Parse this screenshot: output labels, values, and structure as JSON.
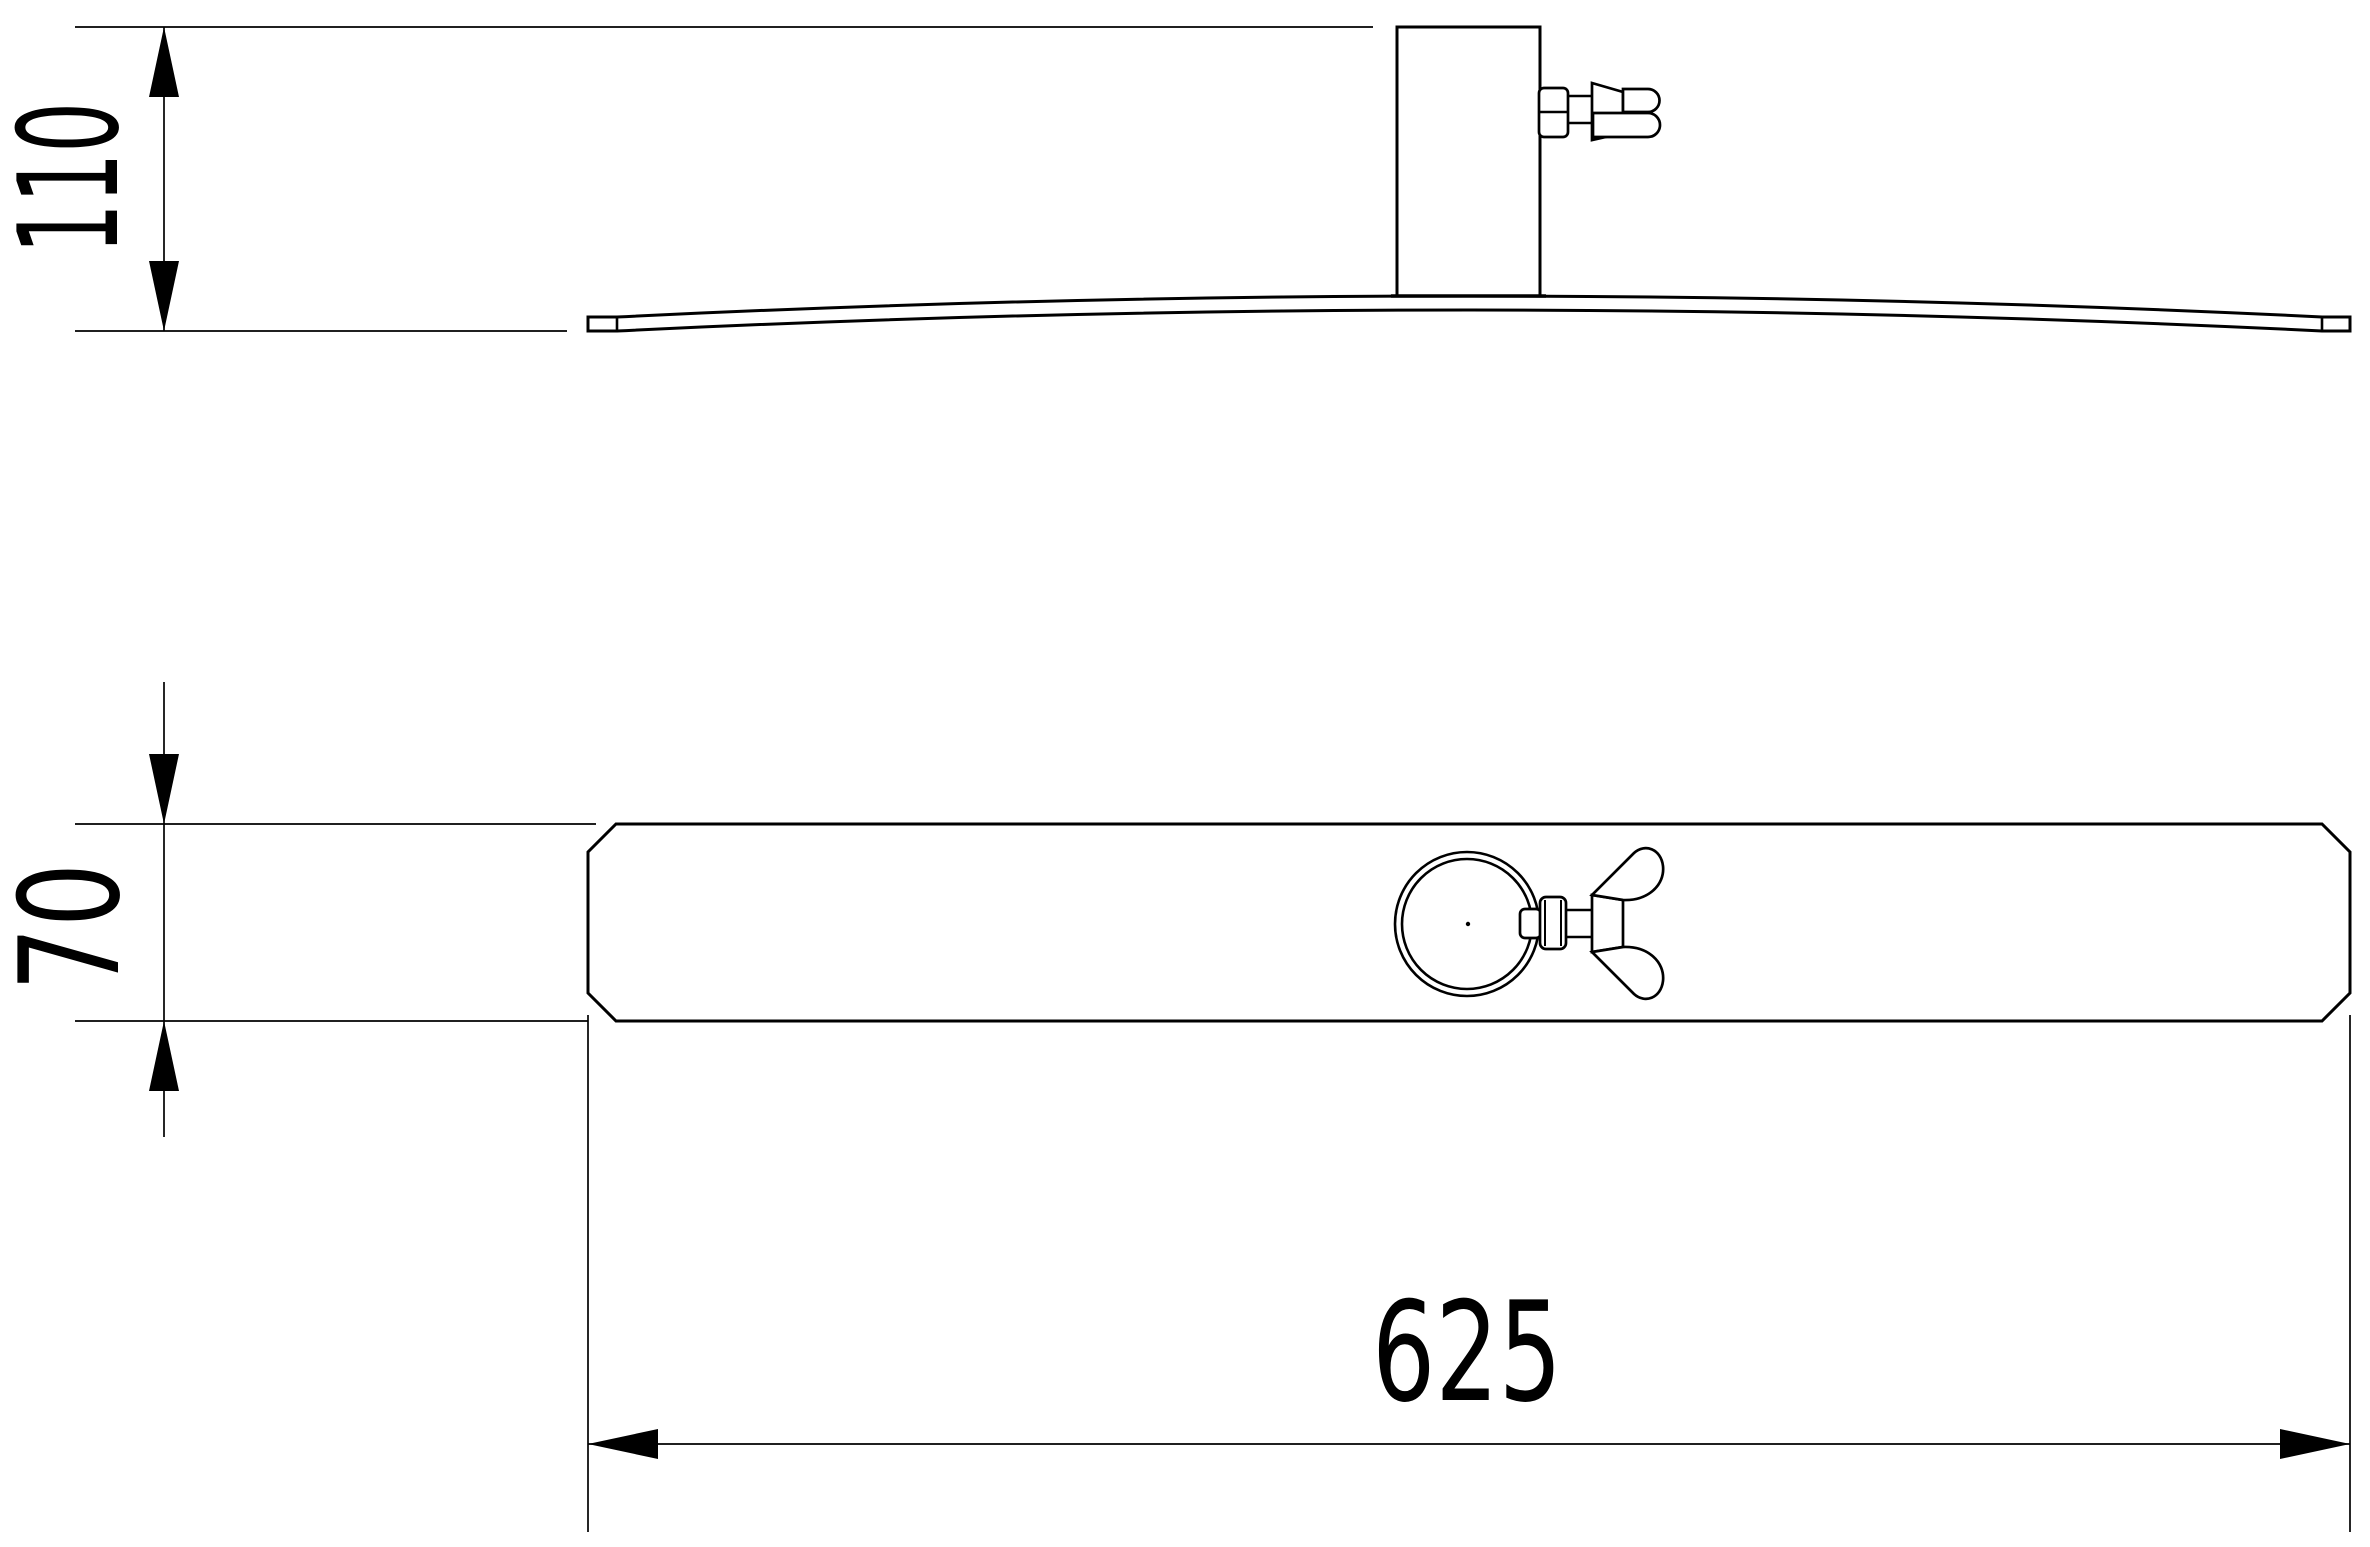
{
  "page": {
    "background_color": "#ffffff",
    "line_color": "#000000"
  },
  "drawing": {
    "dimensions": {
      "overall_height": {
        "label": "110"
      },
      "plate_depth": {
        "label": "70"
      },
      "plate_length": {
        "label": "625"
      }
    }
  }
}
